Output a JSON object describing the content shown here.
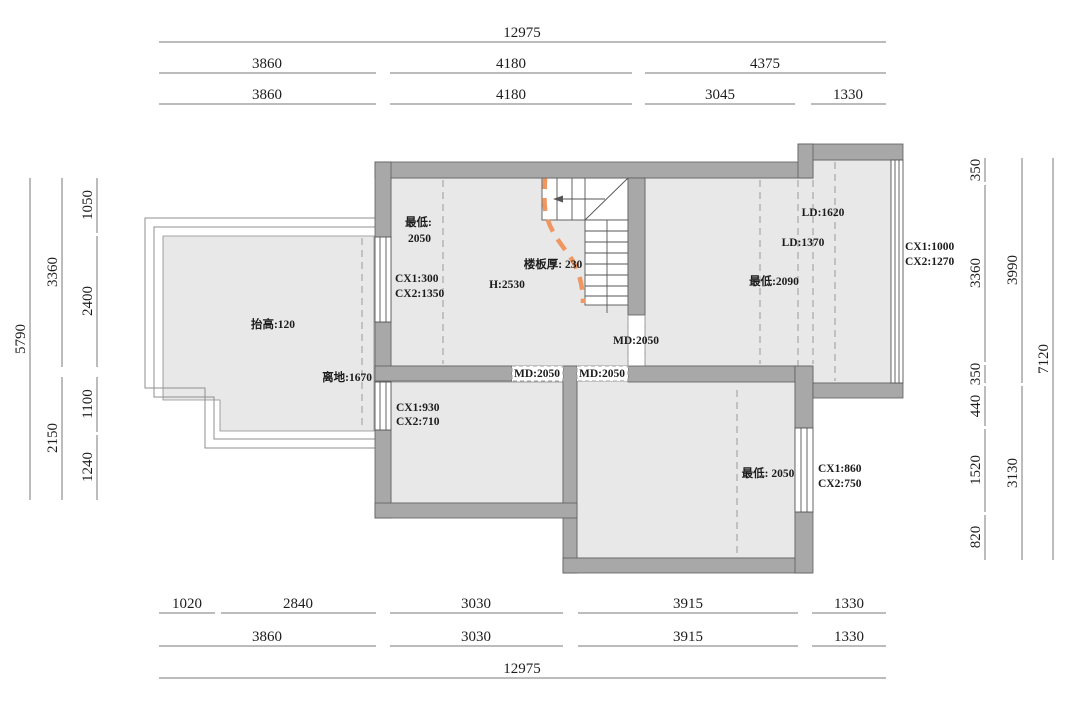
{
  "title": "second-floor attic plan with ceiling-height annotations",
  "colors": {
    "wall": "#a8a8a8",
    "floor": "#e8e8e8",
    "accent_dash": "#ef9661",
    "dim_line": "#7a7a7a",
    "text": "#1c1c1c"
  },
  "dims": {
    "top": [
      [
        "12975"
      ],
      [
        "3860",
        "4180",
        "4375"
      ],
      [
        "3860",
        "4180",
        "3045",
        "1330"
      ]
    ],
    "bottom": [
      [
        "1020",
        "2840",
        "3030",
        "3915",
        "1330"
      ],
      [
        "3860",
        "3030",
        "3915",
        "1330"
      ],
      [
        "12975"
      ]
    ],
    "left": [
      [
        "5790"
      ],
      [
        "3360",
        "2150"
      ],
      [
        "1050",
        "2400",
        "1100",
        "1240"
      ]
    ],
    "right": [
      [
        "350",
        "3360",
        "350",
        "440",
        "1520",
        "820"
      ],
      [
        "3990",
        "3130"
      ],
      [
        "7120"
      ]
    ]
  },
  "labels": {
    "tl_min_1": "最低:",
    "tl_min_2": "2050",
    "tl_cx_1": "CX1:300",
    "tl_cx_2": "CX2:1350",
    "terrace": "抬高:120",
    "lidi": "离地:1670",
    "slab": "楼板厚: 230",
    "height": "H:2530",
    "md_stair": "MD:2050",
    "md_door1": "MD:2050",
    "md_door2": "MD:2050",
    "r_ld1": "LD:1620",
    "r_ld2": "LD:1370",
    "r_min": "最低:2090",
    "r_cx_1": "CX1:1000",
    "r_cx_2": "CX2:1270",
    "bl_cx_1": "CX1:930",
    "bl_cx_2": "CX2:710",
    "br_min": "最低: 2050",
    "br_cx_1": "CX1:860",
    "br_cx_2": "CX2:750"
  }
}
